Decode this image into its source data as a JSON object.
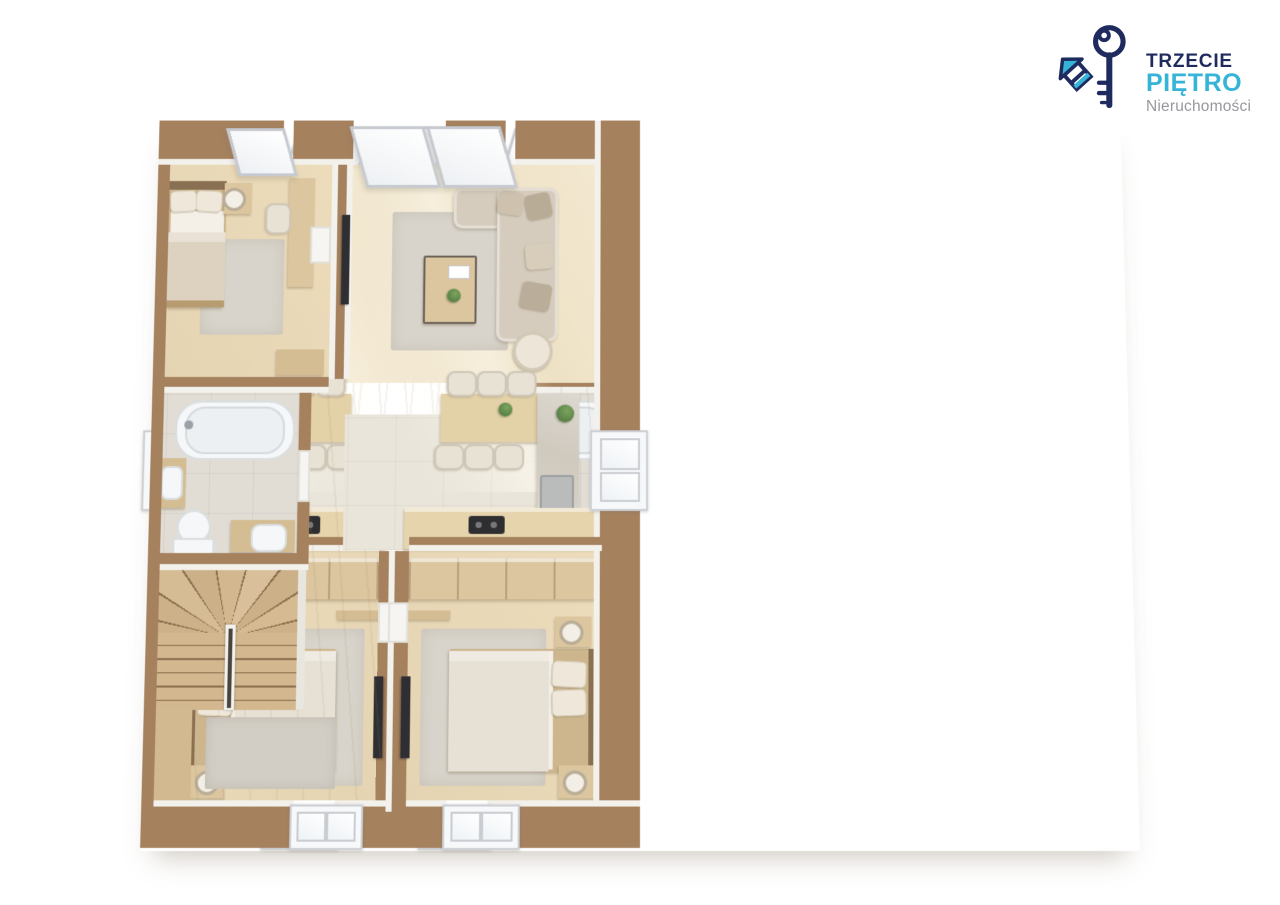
{
  "logo": {
    "brand_line1": "TRZECIE",
    "brand_line2": "PIĘTRO",
    "brand_line3": "Nieruchomości",
    "icon": "key-house-icon"
  },
  "palette": {
    "bg": "#ffffff",
    "wall": "#a5815e",
    "wall_face": "#f3f1ec",
    "wall_light": "#e9e6e0",
    "wood": "#e9dcc0",
    "wood_light": "#f1e7d1",
    "wood_mid": "#dcc69f",
    "wood_dark": "#c9ac84",
    "tile": "#e1ddd5",
    "tile_warm": "#eae5da",
    "rug": "#d8d4cb",
    "rug_dark": "#d2cec5",
    "sofa": "#d6ccbd",
    "white_fixture": "#f6f7f8",
    "fixture_line": "#d9dee1",
    "tv": "#2f2f33",
    "plant": "#628b4e",
    "logo_navy": "#1f2b5e",
    "logo_cyan": "#35b4d8",
    "logo_gray": "#97989d"
  }
}
